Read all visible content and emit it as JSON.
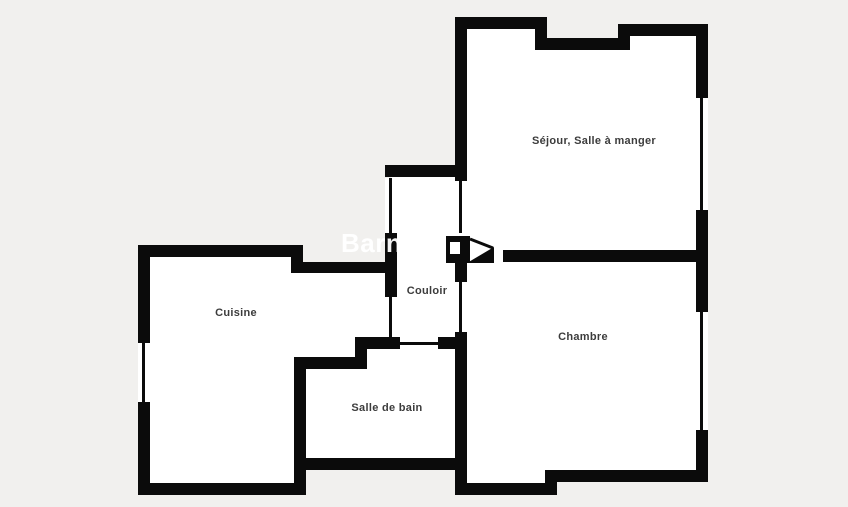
{
  "plan": {
    "kind": "apartment-floor-plan",
    "colors": {
      "background": "#f1f0ee",
      "wall": "#0b0b0b",
      "floor": "#ffffff",
      "label_text": "#3c3c3c",
      "watermark_text": "#ffffff"
    }
  },
  "watermark": {
    "text": "Barnes"
  },
  "rooms": {
    "sejour": {
      "label": "Séjour, Salle à manger"
    },
    "chambre": {
      "label": "Chambre"
    },
    "couloir": {
      "label": "Couloir"
    },
    "salle_de_bain": {
      "label": "Salle de bain"
    },
    "cuisine": {
      "label": "Cuisine"
    }
  },
  "features": {
    "windows": [
      "sejour-east-window",
      "chambre-east-window",
      "cuisine-west-window",
      "couloir-west-window"
    ],
    "doors": [
      "couloir-sejour-door",
      "couloir-chambre-door",
      "couloir-salle-de-bain-door",
      "couloir-cuisine-door",
      "entry-door-swing-symbol"
    ]
  }
}
